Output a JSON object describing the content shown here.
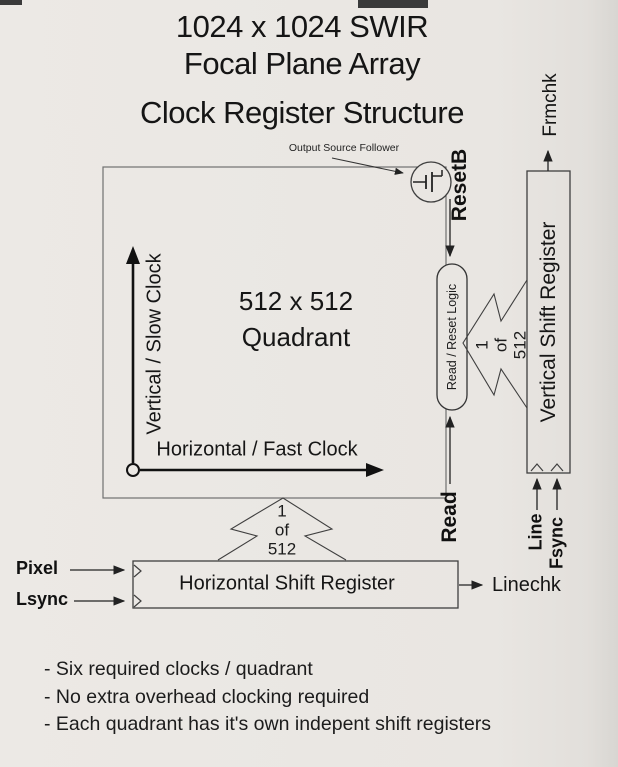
{
  "title": {
    "line1": "1024 x 1024 SWIR",
    "line2": "Focal Plane Array",
    "line3": "Clock Register Structure"
  },
  "array": {
    "quadrant_line1": "512 x 512",
    "quadrant_line2": "Quadrant",
    "vertical_axis_label": "Vertical / Slow Clock",
    "horizontal_axis_label": "Horizontal / Fast Clock",
    "output_source_follower": "Output Source Follower"
  },
  "registers": {
    "vertical": "Vertical Shift Register",
    "horizontal": "Horizontal Shift Register",
    "read_reset_logic": "Read / Reset Logic"
  },
  "mux": {
    "line1": "1",
    "line2": "of",
    "line3": "512"
  },
  "signals": {
    "resetb": "ResetB",
    "read": "Read",
    "frmchk": "Frmchk",
    "linechk": "Linechk",
    "pixel": "Pixel",
    "lsync": "Lsync",
    "line": "Line",
    "fsync": "Fsync"
  },
  "notes": [
    "- Six required clocks / quadrant",
    "- No extra overhead clocking required",
    "- Each quadrant has it's own indepent shift registers"
  ],
  "colors": {
    "paper": "#e9e6e2",
    "ink": "#1a1a1a",
    "thin_line": "#4a4a4a",
    "box_border": "#6f6f6f"
  }
}
